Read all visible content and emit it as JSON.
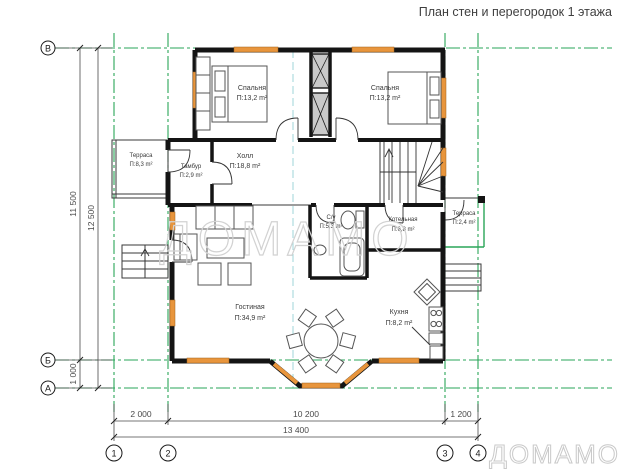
{
  "title": "План стен и перегородок 1 этажа",
  "watermark": "ДОМАМО",
  "rooms": {
    "bedroom_left": {
      "name": "Спальня",
      "area": "П:13,2 m²"
    },
    "bedroom_right": {
      "name": "Спальня",
      "area": "П:13,2 m²"
    },
    "terrace_left": {
      "name": "Терраса",
      "area": "П:8,3 m²"
    },
    "tambour": {
      "name": "Тамбур",
      "area": "П:2,9 m²"
    },
    "hall": {
      "name": "Холл",
      "area": "П:18,8 m²"
    },
    "wc": {
      "name": "С/у",
      "area": "П:5,3 m²"
    },
    "boiler": {
      "name": "Котельная",
      "area": "П:6,8 m²"
    },
    "terrace_right": {
      "name": "Терраса",
      "area": "П:2,4 m²"
    },
    "living": {
      "name": "Гостиная",
      "area": "П:34,9 m²"
    },
    "kitchen": {
      "name": "Кухня",
      "area": "П:8,2 m²"
    }
  },
  "axes": {
    "rows": [
      "В",
      "Б",
      "А"
    ],
    "cols": [
      "1",
      "2",
      "3",
      "4"
    ]
  },
  "dimensions": {
    "bottom": [
      "2 000",
      "10 200",
      "1 200",
      "13 400"
    ],
    "left": [
      "11 500",
      "12 500",
      "1 000"
    ]
  },
  "colors": {
    "wall": "#141414",
    "window": "#e8953c",
    "axis_green": "#2aa558",
    "axis_teal": "#9fd4d8",
    "dim": "#4a4a4a",
    "watermark": "#d2d2d2"
  }
}
